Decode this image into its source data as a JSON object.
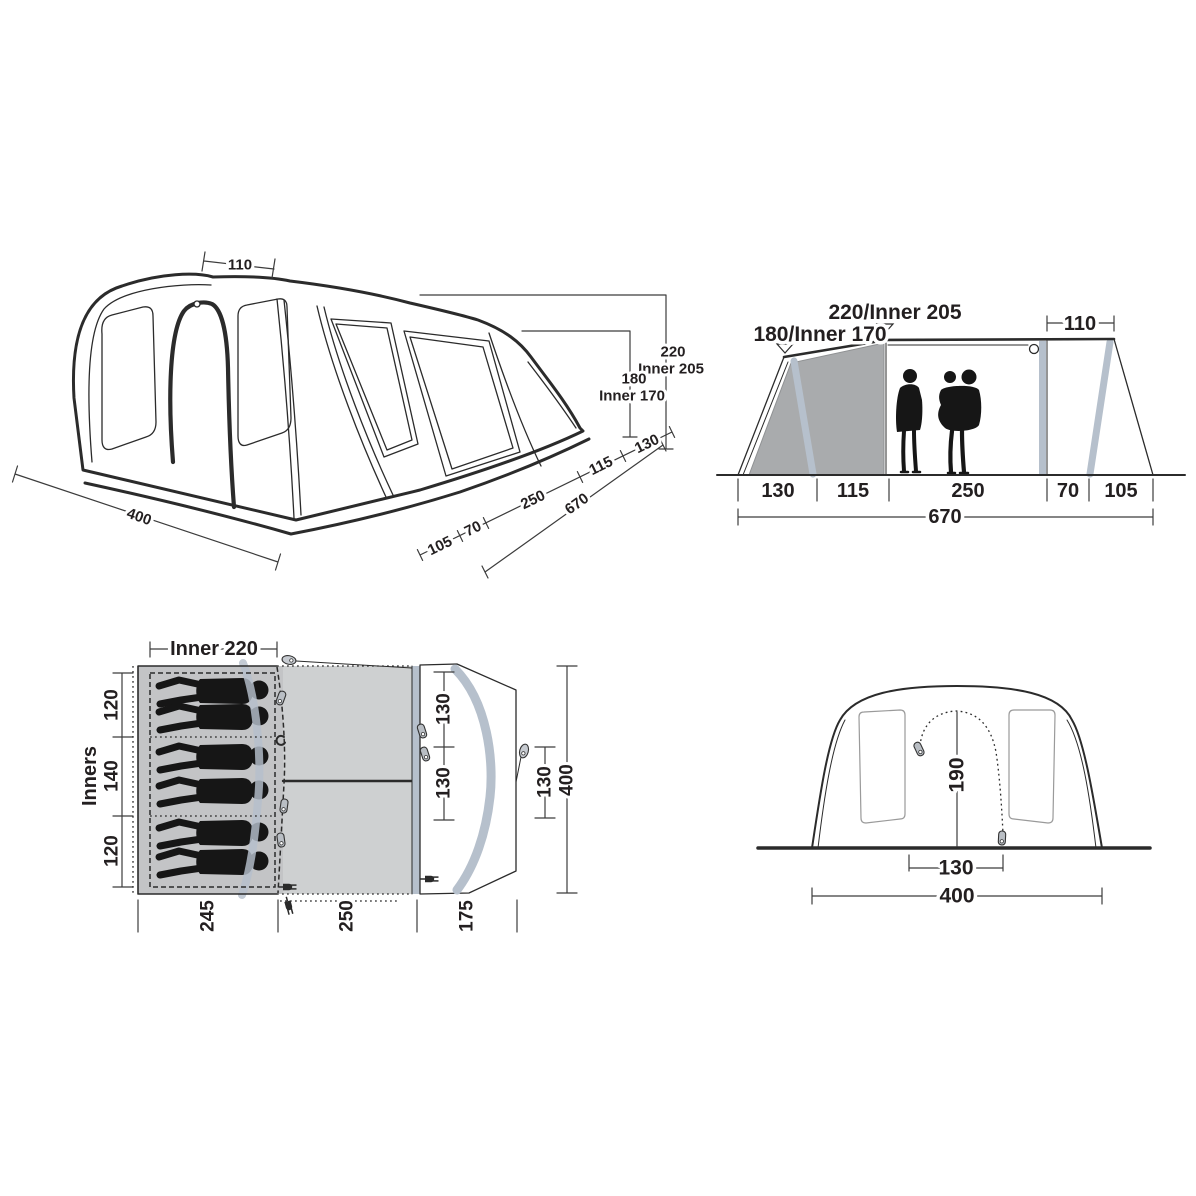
{
  "colors": {
    "line": "#2b2b2b",
    "panel_gray": "#a9abad",
    "pole_blue": "#b6c0cc",
    "bedroom_gray": "#c3c4c6",
    "living_gray": "#ced0d1",
    "silhouette": "#161616"
  },
  "views": {
    "perspective": {
      "top_width": "110",
      "height": "220",
      "height_inner": "Inner 205",
      "wall_height": "180",
      "wall_height_inner": "Inner 170",
      "segments": [
        "130",
        "115",
        "250",
        "70",
        "105"
      ],
      "length": "670",
      "width": "400"
    },
    "side": {
      "front_height": "180/Inner 170",
      "peak_height": "220/Inner 205",
      "rear_top_width": "110",
      "segments": [
        "130",
        "115",
        "250",
        "70",
        "105"
      ],
      "total_length": "670"
    },
    "floor": {
      "inner_width": "Inner 220",
      "inners_label": "Inners",
      "bedroom_depths": [
        "120",
        "140",
        "120"
      ],
      "living_depths": [
        "130",
        "130"
      ],
      "porch_depth": "130",
      "total_depth": "400",
      "section_lengths": [
        "245",
        "250",
        "175"
      ]
    },
    "front": {
      "door_height": "190",
      "door_width": "130",
      "total_width": "400"
    }
  }
}
